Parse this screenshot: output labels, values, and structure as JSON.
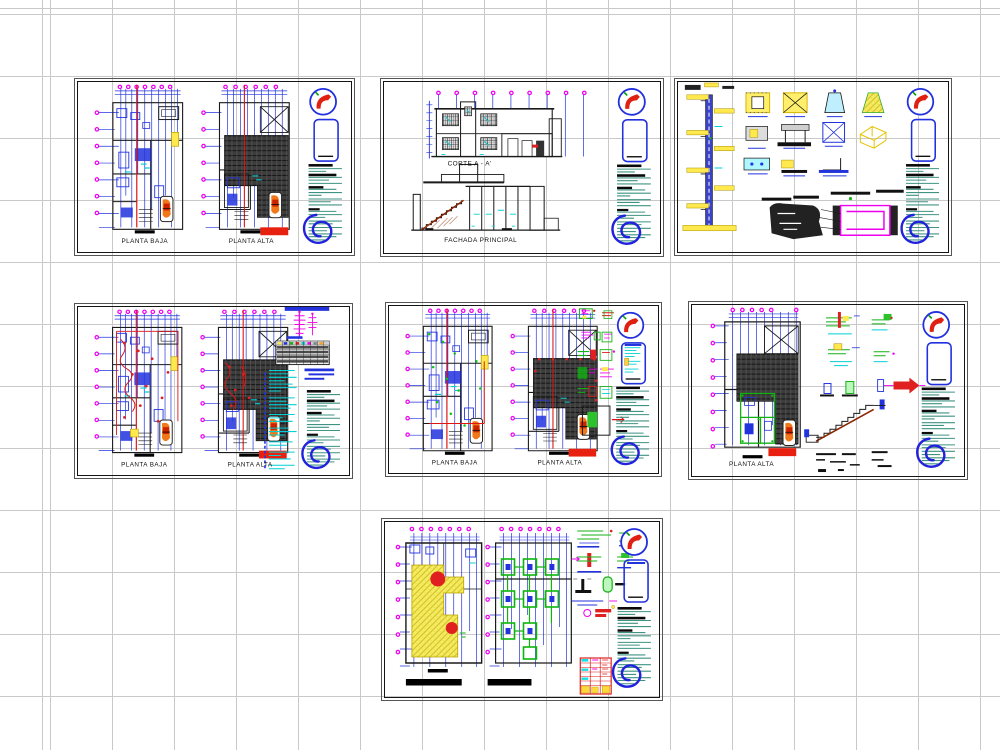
{
  "app": {
    "description": "CAD multi-sheet layout preview of a two-storey house project",
    "background": "#ffffff",
    "grid_color": "#c9c9c9"
  },
  "palette": {
    "axis_bubble_magenta": "#f000f0",
    "cad_blue": "#2233dd",
    "cad_red": "#dd1515",
    "cad_cyan": "#00cfd5",
    "cad_green": "#12b212",
    "cad_yellow": "#ffe94d",
    "notes_teal": "#3f9383",
    "logo_blue": "#2222dd",
    "north_arrow_red": "#e02010",
    "roof_hatch_dark": "#3c3c3c"
  },
  "sheets": [
    {
      "name": "architectural-plans",
      "labels": {
        "left": "PLANTA BAJA",
        "right": "PLANTA ALTA"
      }
    },
    {
      "name": "section-and-elevation",
      "labels": {
        "top": "CORTE A - A'",
        "bottom": "FACHADA PRINCIPAL"
      }
    },
    {
      "name": "construction-details",
      "labels": {}
    },
    {
      "name": "electrical-plans",
      "labels": {
        "left": "PLANTA BAJA",
        "right": "PLANTA ALTA"
      }
    },
    {
      "name": "sanitary-plans",
      "labels": {
        "left": "PLANTA BAJA",
        "right": "PLANTA ALTA"
      }
    },
    {
      "name": "roof-and-stair-details",
      "labels": {
        "left": "PLANTA ALTA"
      }
    },
    {
      "name": "foundation-plans",
      "labels": {}
    }
  ]
}
